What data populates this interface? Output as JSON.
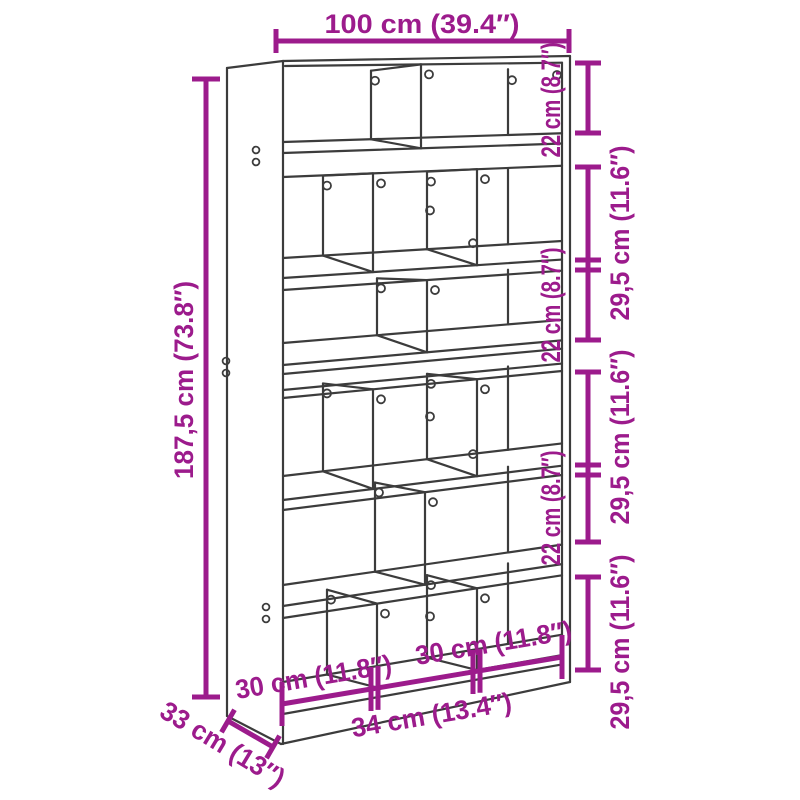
{
  "diagram": {
    "type": "furniture-dimension-diagram",
    "subject": "bookcase room divider line drawing",
    "accent_color": "#9c1b8c",
    "line_color": "#3c3c3c",
    "background_color": "#ffffff"
  },
  "dimensions": {
    "width_label": "100 cm (39.4″)",
    "height_label": "187,5 cm (73.8″)",
    "depth_label": "33 cm (13″)",
    "right_inner_labels": [
      "22 cm (8.7″)",
      "22 cm (8.7″)",
      "22 cm (8.7″)"
    ],
    "right_outer_labels": [
      "29,5 cm (11.6″)",
      "29,5 cm (11.6″)",
      "29,5 cm (11.6″)"
    ],
    "bottom_labels": [
      "30 cm (11.8″)",
      "30 cm (11.8″)",
      "34 cm (13.4″)"
    ]
  }
}
